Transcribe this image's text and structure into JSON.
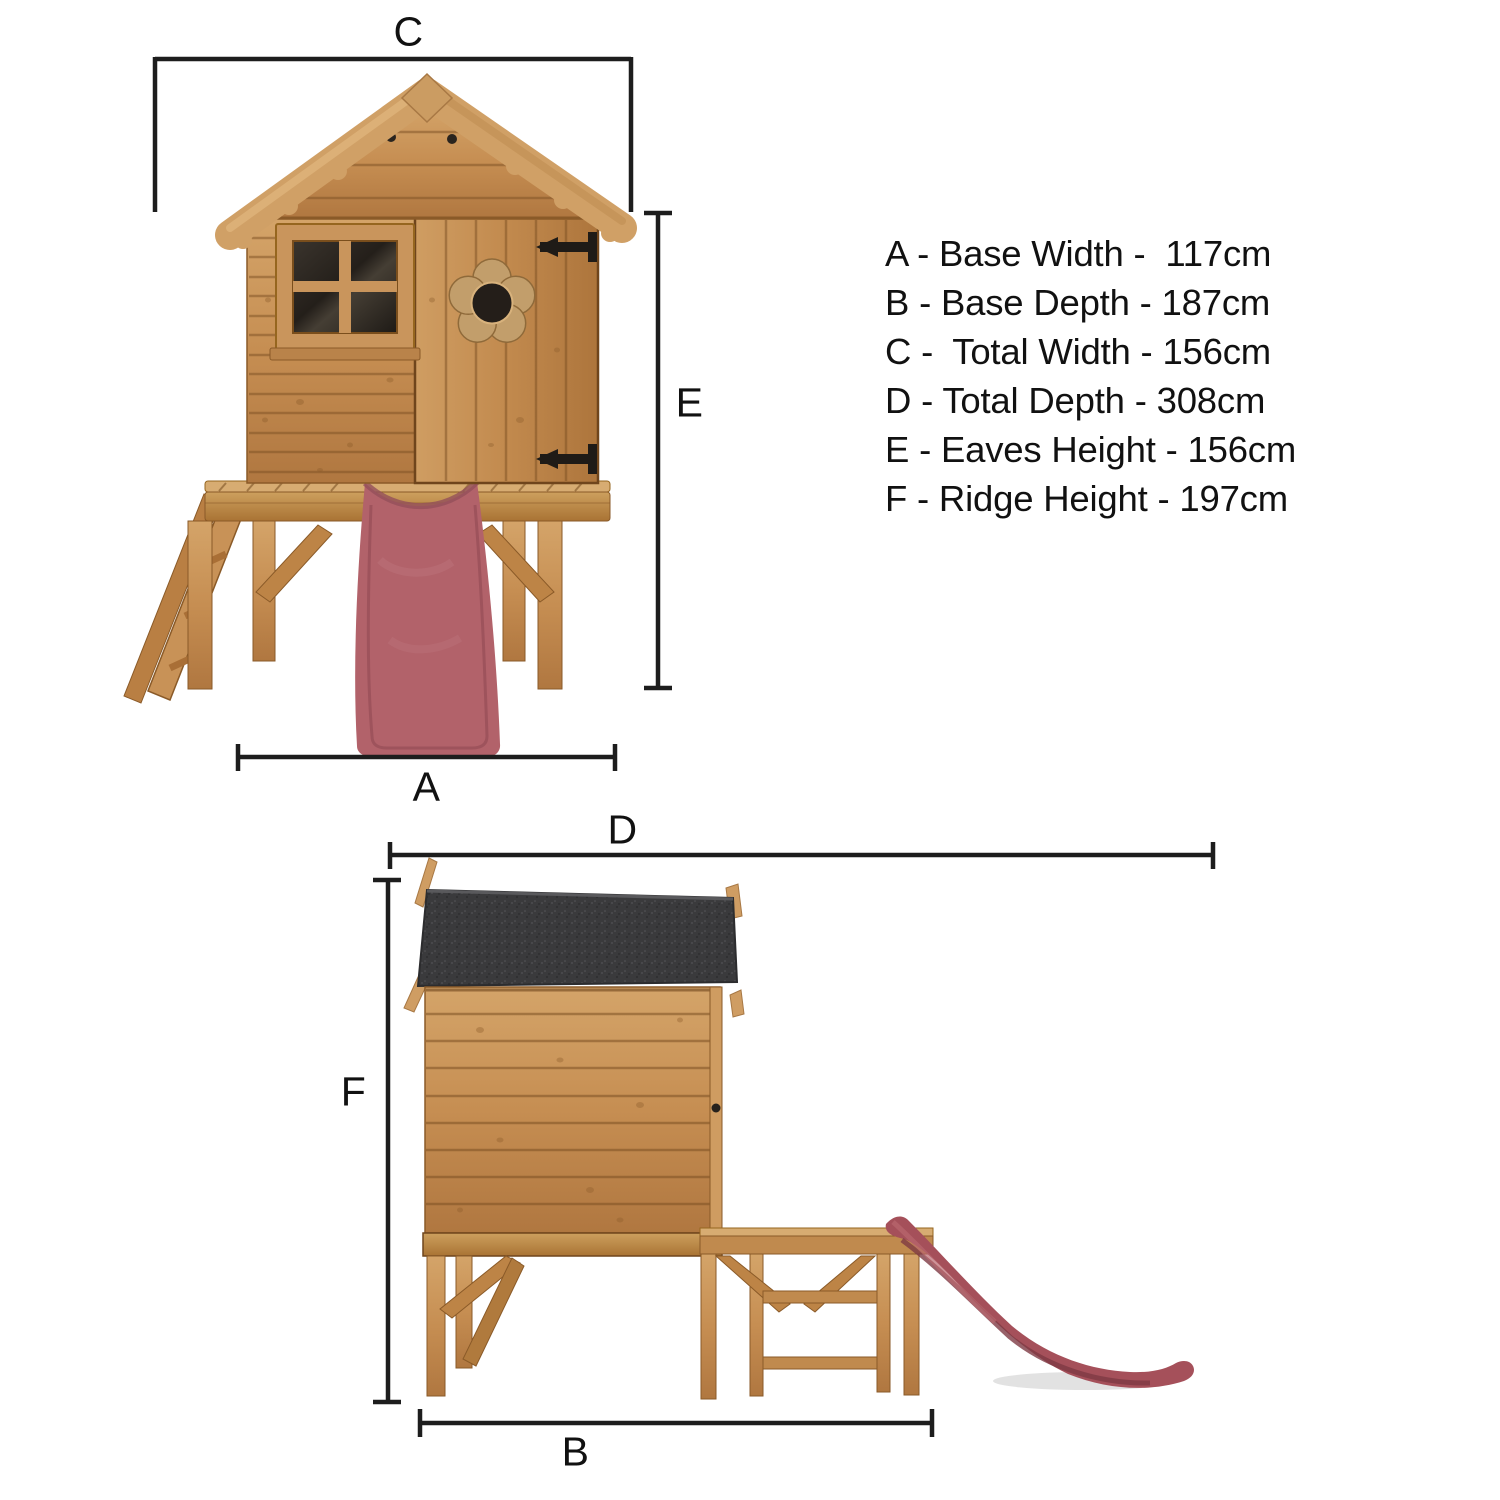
{
  "views": {
    "front": {
      "dim_labels": {
        "c": "C",
        "e": "E",
        "a": "A"
      }
    },
    "side": {
      "dim_labels": {
        "d": "D",
        "f": "F",
        "b": "B"
      }
    }
  },
  "legend": {
    "items": [
      "A - Base Width -  117cm",
      "B - Base Depth - 187cm",
      "C -  Total Width - 156cm",
      "D - Total Depth - 308cm",
      "E - Eaves Height - 156cm",
      "F - Ridge Height - 197cm"
    ]
  },
  "colors": {
    "background": "#ffffff",
    "dimension_line": "#1d1d1d",
    "text": "#111111",
    "wood_light": "#d7ac72",
    "wood_mid": "#c68e52",
    "wood_dark": "#a06c36",
    "bargeboard": "#d0a066",
    "roof_felt": "#3a3a3c",
    "slide_red_front": "#b2626a",
    "slide_red_side": "#a5505a",
    "window_glass": "#262018",
    "hinge_black": "#1f1b17"
  }
}
